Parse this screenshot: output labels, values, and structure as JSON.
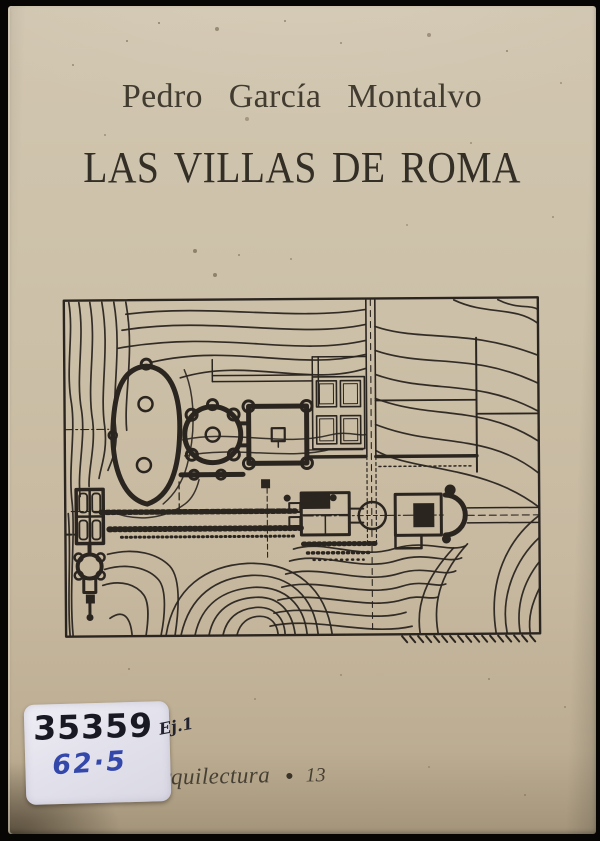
{
  "photo": {
    "backdrop_color": "#070605",
    "cover_color": "#c9bca4",
    "ink_color": "#2b2520"
  },
  "cover": {
    "author": "Pedro García Montalvo",
    "title": "LAS VILLAS DE ROMA",
    "series_name": "Arquilectura",
    "series_bullet": "●",
    "series_number": "13"
  },
  "library_label": {
    "accession_number": "35359",
    "copy_mark": "Ej.1",
    "shelf_mark": "62·5",
    "label_color": "#e4e3ec",
    "marker_ink_color": "#191923",
    "blue_ink_color": "#3448ab"
  },
  "plan": {
    "alt": "Site plan line drawing of a Roman villa with terrain contour lines, oval garden, round and square courtyards and terraces"
  }
}
